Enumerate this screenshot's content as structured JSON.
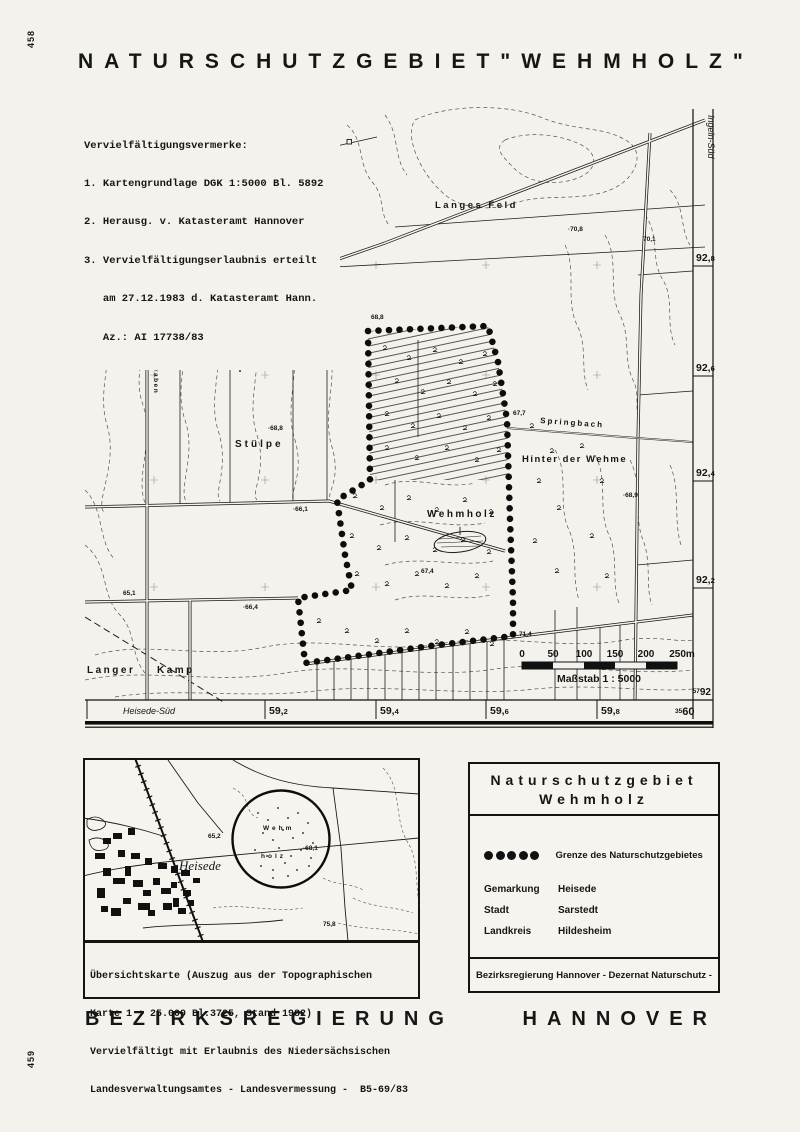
{
  "page": {
    "paper_color": "#f4f2ec",
    "ink_color": "#161616",
    "sheet_number_top": "458",
    "sheet_number_bottom": "459",
    "title_word1": "NATURSCHUTZGEBIET",
    "title_word2": "\"WEHMHOLZ\"",
    "footer_word1": "BEZIRKSREGIERUNG",
    "footer_word2": "HANNOVER"
  },
  "notes": {
    "heading": "Vervielfältigungsvermerke:",
    "lines": [
      "1. Kartengrundlage DGK 1:5000 Bl. 5892",
      "2. Herausg. v. Katasteramt Hannover",
      "3. Vervielfältigungserlaubnis erteilt",
      "   am 27.12.1983 d. Katasteramt Hann.",
      "   Az.: AI 17738/83"
    ]
  },
  "map": {
    "labels": {
      "langes_feld": "Langes Feld",
      "stuelpe": "Stülpe",
      "springbach": "Springbach",
      "hinter_der_wehme": "Hinter der Wehme",
      "wehmholz": "Wehmholz",
      "langer": "Langer",
      "kamp": "Kamp",
      "wehmegraben": "Wehmegraben",
      "north": "N"
    },
    "elevations": [
      "65,3",
      "·70,8",
      "70,1",
      "68,8",
      "67,7",
      "·68,9",
      "·68,8",
      "·66,1",
      "65,1",
      "·66,4",
      "67,4",
      "71,4"
    ],
    "margins": {
      "right_sheet": "Ingeln-Süd",
      "bottom_sheet": "Heisede-Süd",
      "right_grid": [
        {
          "main": "92,",
          "dec": "8"
        },
        {
          "main": "92,",
          "dec": "6"
        },
        {
          "main": "92,",
          "dec": "4"
        },
        {
          "main": "92,",
          "dec": "2"
        }
      ],
      "bottom_grid": [
        {
          "main": "59,",
          "dec": "2"
        },
        {
          "main": "59,",
          "dec": "4"
        },
        {
          "main": "59,",
          "dec": "6"
        },
        {
          "main": "59,",
          "dec": "8"
        }
      ],
      "corner_right": {
        "small": "57",
        "large": "92"
      },
      "corner_bottom": {
        "small": "35",
        "large": "60"
      }
    },
    "scalebar": {
      "ticks": [
        "0",
        "50",
        "100",
        "150",
        "200",
        "250m"
      ],
      "caption": "Maßstab 1 : 5000"
    }
  },
  "overview": {
    "town": "Heisede",
    "circle_word1": "Wehm",
    "circle_word2": "holz",
    "elevations": [
      "65,2",
      "·68,1",
      "75,8"
    ],
    "caption_lines": [
      "Übersichtskarte (Auszug aus der Topographischen",
      "Karte 1 : 25.000 Bl.3725, Stand 1982)",
      "Vervielfältigt mit Erlaubnis des Niedersächsischen",
      "Landesverwaltungsamtes - Landesvermessung -  B5-69/83"
    ]
  },
  "legend": {
    "title_line1": "Naturschutzgebiet",
    "title_line2": "Wehmholz",
    "boundary_label": "Grenze des Naturschutzgebietes",
    "rows": [
      {
        "key": "Gemarkung",
        "value": "Heisede"
      },
      {
        "key": "Stadt",
        "value": "Sarstedt"
      },
      {
        "key": "Landkreis",
        "value": "Hildesheim"
      }
    ],
    "footer": "Bezirksregierung Hannover  - Dezernat Naturschutz -"
  }
}
